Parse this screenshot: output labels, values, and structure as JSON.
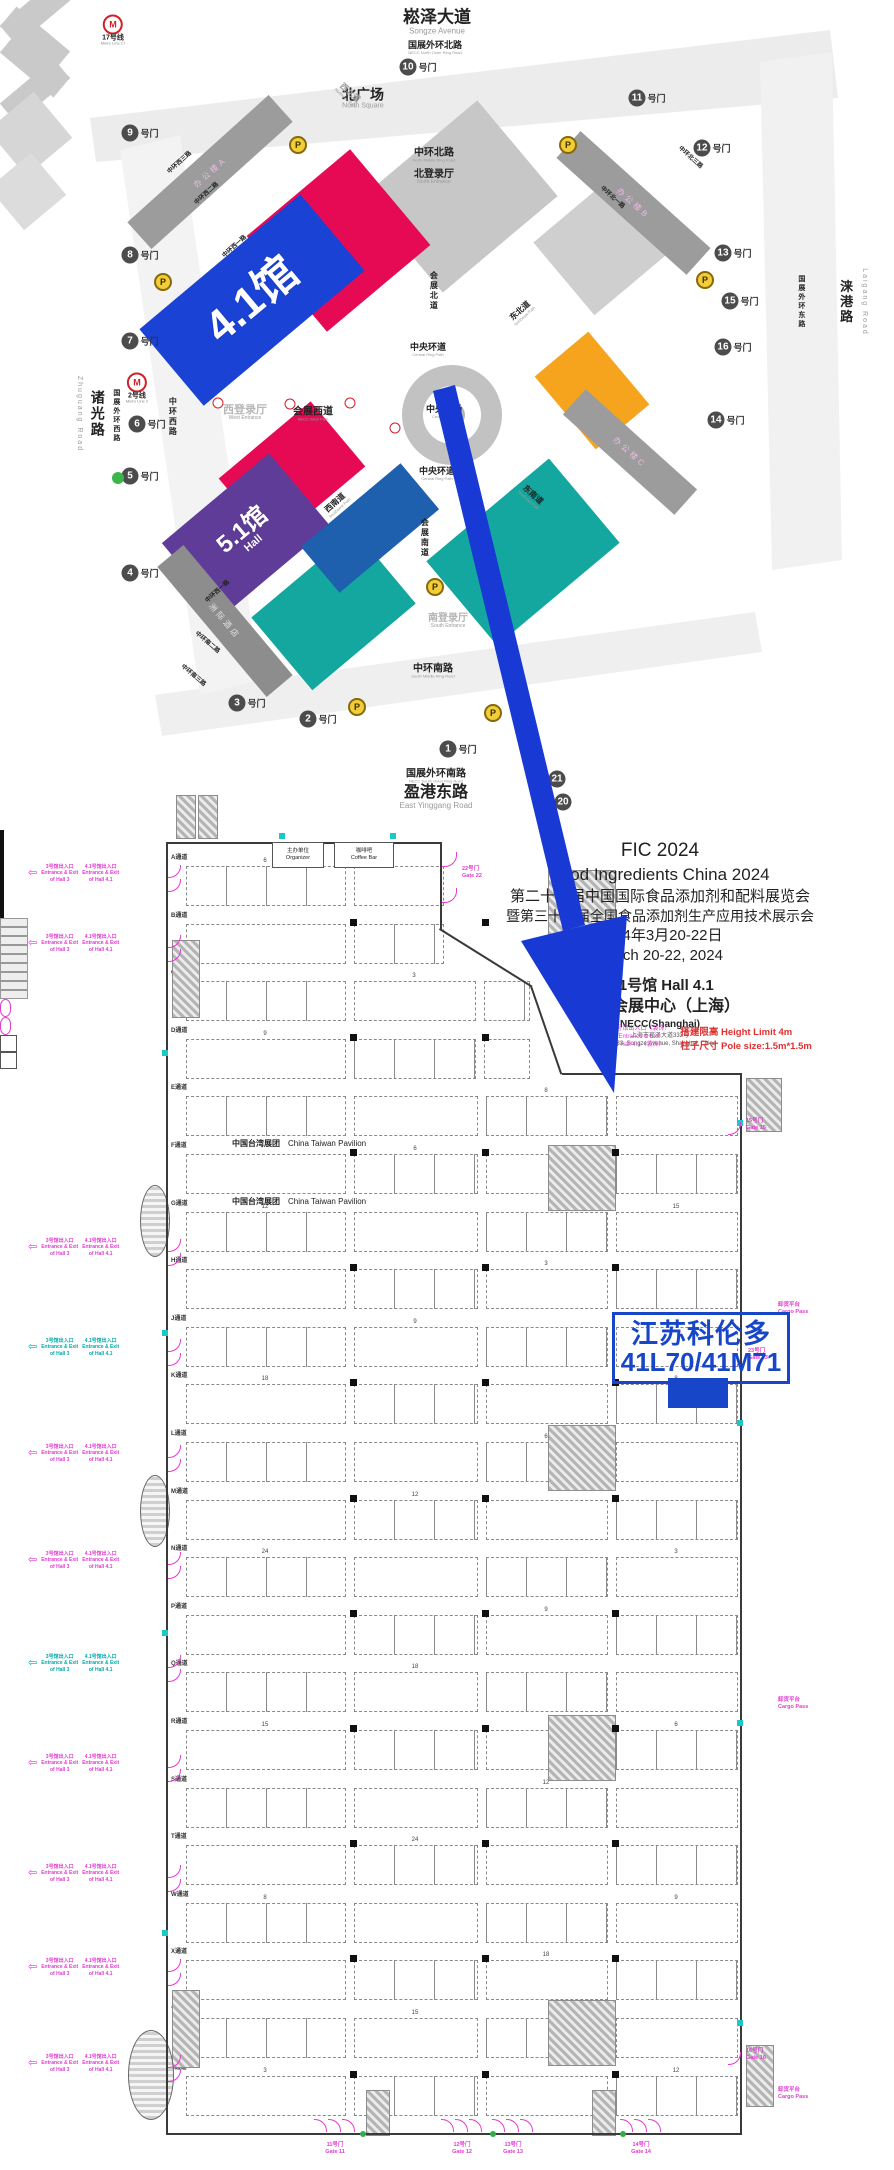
{
  "colors": {
    "arrow": "#1839d4",
    "highlight": "#1746c8",
    "booth_fill": "#1746c8",
    "hall_red": "#e60a55",
    "hall_blue": "#1a42d4",
    "hall_grey": "#c7c7c7",
    "hall_grey2": "#cfcfcf",
    "hall_purple": "#5e3c98",
    "hall_teal": "#14a79f",
    "hall_darkblue": "#1e5fae",
    "hall_orange": "#f6a41e",
    "magenta": "#e23bd0",
    "cad_teal": "#00aaa8",
    "red_note": "#e03030",
    "gate_circle": "#4c4c4c"
  },
  "map": {
    "gate_suffix": "号门",
    "parking_label": "P",
    "gates": [
      {
        "n": "10",
        "x": 418,
        "y": 67
      },
      {
        "n": "9",
        "x": 140,
        "y": 133
      },
      {
        "n": "8",
        "x": 140,
        "y": 255
      },
      {
        "n": "7",
        "x": 140,
        "y": 341
      },
      {
        "n": "6",
        "x": 147,
        "y": 424
      },
      {
        "n": "5",
        "x": 140,
        "y": 476
      },
      {
        "n": "4",
        "x": 140,
        "y": 573
      },
      {
        "n": "3",
        "x": 247,
        "y": 703
      },
      {
        "n": "2",
        "x": 318,
        "y": 719
      },
      {
        "n": "1",
        "x": 458,
        "y": 749
      },
      {
        "n": "11",
        "x": 647,
        "y": 98
      },
      {
        "n": "12",
        "x": 712,
        "y": 148
      },
      {
        "n": "13",
        "x": 733,
        "y": 253
      },
      {
        "n": "15",
        "x": 740,
        "y": 301
      },
      {
        "n": "16",
        "x": 733,
        "y": 347
      },
      {
        "n": "14",
        "x": 726,
        "y": 420
      },
      {
        "n": "21",
        "x": 557,
        "y": 779,
        "bare": true
      },
      {
        "n": "20",
        "x": 563,
        "y": 802,
        "bare": true
      }
    ],
    "parkings": [
      [
        298,
        145
      ],
      [
        163,
        282
      ],
      [
        568,
        145
      ],
      [
        705,
        280
      ],
      [
        435,
        587
      ],
      [
        357,
        707
      ],
      [
        493,
        713
      ],
      [
        530,
        744
      ]
    ],
    "metros": [
      {
        "t": "17号线",
        "e": "Metro Line 17",
        "x": 113,
        "y": 30
      },
      {
        "t": "2号线",
        "e": "Metro Line 2",
        "x": 137,
        "y": 388
      }
    ],
    "metro_minis": [
      [
        218,
        403
      ],
      [
        290,
        404
      ],
      [
        350,
        403
      ],
      [
        395,
        428
      ]
    ],
    "green_dot": [
      118,
      478
    ],
    "halls": [
      {
        "name": "hall-grey-ne1",
        "x": 460,
        "y": 196,
        "w": 150,
        "h": 125,
        "c": "hall_grey"
      },
      {
        "name": "hall-grey-ne2",
        "x": 606,
        "y": 243,
        "w": 110,
        "h": 95,
        "c": "hall_grey2"
      },
      {
        "name": "hall-4-2",
        "x": 338,
        "y": 240,
        "w": 135,
        "h": 125,
        "c": "hall_red"
      },
      {
        "name": "hall-4-1",
        "x": 252,
        "y": 300,
        "w": 210,
        "h": 100,
        "c": "hall_blue",
        "label": "4.1馆",
        "fs": 44
      },
      {
        "name": "hall-5-1-red",
        "x": 292,
        "y": 472,
        "w": 120,
        "h": 85,
        "c": "hall_red"
      },
      {
        "name": "hall-5-1",
        "x": 246,
        "y": 534,
        "w": 140,
        "h": 95,
        "c": "hall_purple",
        "label": "5.1馆",
        "label2": "Hall",
        "fs": 24
      },
      {
        "name": "hall-teal-s",
        "x": 333,
        "y": 610,
        "w": 135,
        "h": 95,
        "c": "hall_teal"
      },
      {
        "name": "hall-darkblue",
        "x": 370,
        "y": 528,
        "w": 130,
        "h": 60,
        "c": "hall_darkblue"
      },
      {
        "name": "hall-teal-se",
        "x": 523,
        "y": 552,
        "w": 160,
        "h": 110,
        "c": "hall_teal"
      },
      {
        "name": "hall-orange",
        "x": 592,
        "y": 390,
        "w": 70,
        "h": 95,
        "c": "hall_orange"
      }
    ],
    "strips": [
      {
        "t": "办公楼A",
        "x": 210,
        "y": 172,
        "w": 190,
        "h": 36,
        "rot": -42,
        "bg": "#9c9c9c",
        "fg": "#f0b9e4"
      },
      {
        "t": "办公楼B",
        "x": 633,
        "y": 203,
        "w": 175,
        "h": 36,
        "rot": 42,
        "bg": "#9c9c9c",
        "fg": "#f0b9e4"
      },
      {
        "t": "办公楼C",
        "x": 630,
        "y": 452,
        "w": 150,
        "h": 34,
        "rot": 42,
        "bg": "#9c9c9c",
        "fg": "#f0b9e4"
      },
      {
        "t": "洲际酒店",
        "x": 225,
        "y": 621,
        "w": 170,
        "h": 34,
        "rot": 50,
        "bg": "#8d8d8d",
        "fg": "#e3e3e3"
      }
    ],
    "labels": [
      {
        "t": "崧泽大道",
        "e": "Songze Avenue",
        "x": 437,
        "y": 22,
        "fs": 17,
        "efs": 8
      },
      {
        "t": "国展外环北路",
        "e": "NECC North Outer Ring Road",
        "x": 435,
        "y": 48,
        "fs": 9,
        "efs": 4
      },
      {
        "t": "北广场",
        "e": "North Square",
        "x": 363,
        "y": 99,
        "fs": 14,
        "efs": 7
      },
      {
        "t": "中环北路",
        "e": "North Middle Ring Road",
        "x": 434,
        "y": 155,
        "fs": 10,
        "efs": 4
      },
      {
        "t": "北登录厅",
        "e": "North Entrance",
        "x": 434,
        "y": 177,
        "fs": 10,
        "efs": 5,
        "fg": "#222"
      },
      {
        "t": "西登录厅",
        "e": "West Entrance",
        "x": 245,
        "y": 413,
        "fs": 11,
        "efs": 5,
        "fg": "#b8b8b8"
      },
      {
        "t": "会展西道",
        "e": "NECC West Path",
        "x": 313,
        "y": 414,
        "fs": 10,
        "efs": 4
      },
      {
        "t": "中央环道",
        "e": "Central Ring Path",
        "x": 428,
        "y": 350,
        "fs": 9,
        "efs": 4
      },
      {
        "t": "中央环道",
        "e": "Central Ring Path",
        "x": 437,
        "y": 474,
        "fs": 9,
        "efs": 4
      },
      {
        "t": "中央广场",
        "e": "Central Plaza",
        "x": 444,
        "y": 412,
        "fs": 9,
        "efs": 4
      },
      {
        "t": "会展北道",
        "x": 433,
        "y": 291,
        "fs": 8,
        "vert": true
      },
      {
        "t": "会展南道",
        "x": 424,
        "y": 538,
        "fs": 8,
        "vert": true
      },
      {
        "t": "东北道",
        "e": "Northeast Path",
        "x": 522,
        "y": 313,
        "fs": 8,
        "efs": 4,
        "rot": -42
      },
      {
        "t": "西南道",
        "e": "Southwest Path",
        "x": 337,
        "y": 505,
        "fs": 8,
        "efs": 4,
        "rot": -42
      },
      {
        "t": "东南道",
        "e": "Southeast Path",
        "x": 531,
        "y": 497,
        "fs": 8,
        "efs": 4,
        "rot": 42
      },
      {
        "t": "西北道",
        "e": "Northwest Path",
        "x": 348,
        "y": 95,
        "fs": 8,
        "efs": 4,
        "rot": 42,
        "fg": "#9a9a9a"
      },
      {
        "t": "诸光路",
        "x": 97,
        "y": 414,
        "fs": 14,
        "vert": true
      },
      {
        "t": "Zhuguang Road",
        "x": 79,
        "y": 414,
        "fs": 7,
        "vert": true,
        "fg": "#9a9a9a",
        "plain": true
      },
      {
        "t": "国展外环西路",
        "x": 116,
        "y": 416,
        "fs": 7,
        "vert": true
      },
      {
        "t": "中环西路",
        "x": 172,
        "y": 417,
        "fs": 8,
        "vert": true
      },
      {
        "t": "涞港路",
        "x": 845,
        "y": 302,
        "fs": 13,
        "vert": true
      },
      {
        "t": "Laigang Road",
        "x": 864,
        "y": 302,
        "fs": 7,
        "vert": true,
        "fg": "#9a9a9a",
        "plain": true
      },
      {
        "t": "国展外环东路",
        "x": 801,
        "y": 302,
        "fs": 7,
        "vert": true
      },
      {
        "t": "中环西三路",
        "x": 180,
        "y": 163,
        "fs": 6,
        "rot": -42
      },
      {
        "t": "中环西二路",
        "x": 207,
        "y": 194,
        "fs": 6,
        "rot": -42
      },
      {
        "t": "中环西一路",
        "x": 235,
        "y": 247,
        "fs": 6,
        "rot": -42
      },
      {
        "t": "中环西一路",
        "x": 218,
        "y": 592,
        "fs": 6,
        "rot": -42
      },
      {
        "t": "中环南二路",
        "x": 207,
        "y": 643,
        "fs": 6,
        "rot": 40
      },
      {
        "t": "中环南三路",
        "x": 193,
        "y": 676,
        "fs": 6,
        "rot": 40
      },
      {
        "t": "中环北一路",
        "x": 612,
        "y": 198,
        "fs": 6,
        "rot": 42
      },
      {
        "t": "中环北三路",
        "x": 690,
        "y": 158,
        "fs": 6,
        "rot": 42
      },
      {
        "t": "南登录厅",
        "e": "South Entrance",
        "x": 448,
        "y": 621,
        "fs": 10,
        "efs": 5,
        "fg": "#b5b5b5"
      },
      {
        "t": "中环南路",
        "e": "South Middle Ring Road",
        "x": 433,
        "y": 671,
        "fs": 10,
        "efs": 4
      },
      {
        "t": "国展外环南路",
        "e": "NECC South Outer Ring Road",
        "x": 436,
        "y": 776,
        "fs": 10,
        "efs": 4
      },
      {
        "t": "盈港东路",
        "e": "East Yinggang Road",
        "x": 436,
        "y": 797,
        "fs": 16,
        "efs": 8
      }
    ]
  },
  "plan": {
    "exit_arrow": "⇦",
    "title_block": {
      "l1": "FIC 2024",
      "l2": "Food Ingredients China 2024",
      "l3": "第二十七届中国国际食品添加剂和配料展览会",
      "l4": "暨第三十三届全国食品添加剂生产应用技术展示会",
      "l5": "2024年3月20-22日",
      "l6": "March 20-22, 2024",
      "l7": "4.1号馆  Hall 4.1",
      "l8": "国家会展中心（上海）",
      "l9": "NECC(Shanghai)",
      "l10": "上海市崧泽大道333号",
      "l11": "No.333, Songze Avenue, Shanghai, China"
    },
    "notes": {
      "p1": "4.1号馆出入口（装饰）",
      "p2": "Entrance & Exit",
      "p3": "of Hall 4.1（装饰）",
      "r1": "搭建限高 Height Limit 4m",
      "r2": "柱子尺寸 Pole size:1.5m*1.5m"
    },
    "highlight": {
      "line1": "江苏科伦多",
      "line2": "41L70/41M71"
    },
    "pavilion": {
      "t": "中国台湾展团",
      "e": "China Taiwan Pavilion"
    },
    "rooms": [
      {
        "t": "主办单位",
        "e": "Organizer"
      },
      {
        "t": "咖啡吧",
        "e": "Coffee Bar"
      }
    ],
    "gate22": {
      "t": "22号门",
      "e": "Gate 22"
    },
    "gate23": {
      "t": "23号门",
      "e": "Gate 23"
    },
    "cargo": {
      "t": "卸货平台",
      "e": "Cargo Pass"
    },
    "left_block_hall3": {
      "l1": "3号馆出入口",
      "l2": "Entrance & Exit",
      "l3": "of Hall 3"
    },
    "left_block_hall41": {
      "l1": "4.1号馆出入口",
      "l2": "Entrance & Exit",
      "l3": "of Hall 4.1"
    },
    "bottom_gates": [
      {
        "t": "11号门",
        "e": "Gate 11",
        "x": 335
      },
      {
        "t": "12号门",
        "e": "Gate 12",
        "x": 462
      },
      {
        "t": "13号门",
        "e": "Gate 13",
        "x": 513
      },
      {
        "t": "14号门",
        "e": "Gate 14",
        "x": 641
      }
    ],
    "right_gates": [
      {
        "t": "15号门",
        "e": "Gate 15",
        "y": 1122
      },
      {
        "t": "16号门",
        "e": "Gate 16",
        "y": 2052
      }
    ],
    "aisles": [
      "A通道",
      "B通道",
      "C通道",
      "D通道",
      "E通道",
      "F通道",
      "G通道",
      "H通道",
      "J通道",
      "K通道",
      "L通道",
      "M通道",
      "N通道",
      "P通道",
      "Q通道",
      "R通道",
      "S通道",
      "T通道",
      "W通道",
      "X通道",
      "Y通道",
      "Z通道"
    ],
    "dim_values": [
      6,
      9,
      12,
      18,
      24,
      15,
      8,
      3
    ]
  }
}
